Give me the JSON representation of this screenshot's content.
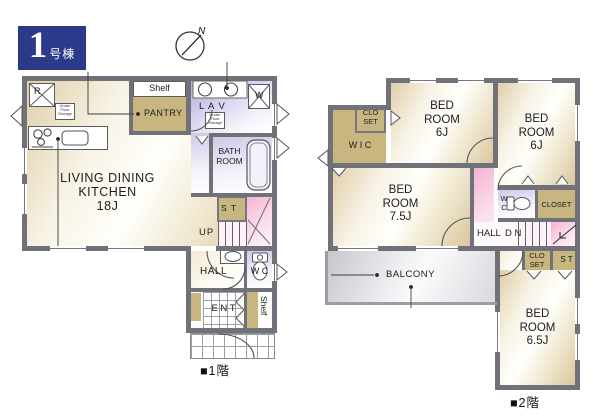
{
  "badge": {
    "number": "1",
    "suffix": "号棟"
  },
  "compass": {
    "north_label": "N"
  },
  "colors": {
    "badge_bg": "#2c3a8a",
    "wall": "#71717a",
    "closet_tan": "#c9b580",
    "stair_pink": "#f3b3d2",
    "wet_area_lavender": "#b3a7d8",
    "room_cream": "#dfcfa8",
    "balcony_gray": "#c6c6cc"
  },
  "floor1": {
    "caption": "■1階",
    "ldk": {
      "line1": "LIVING DINING",
      "line2": "KITCHEN",
      "line3": "18J"
    },
    "labels": {
      "shelf_top": "Shelf",
      "pantry": "PANTRY",
      "lav": "L A V",
      "bath_line1": "BATH",
      "bath_line2": "ROOM",
      "st": "S T",
      "up": "UP",
      "hall": "HALL",
      "wc": "W C",
      "ent": "E N T",
      "shelf_side": "Shelf",
      "fridge": "R",
      "washer": "W",
      "under_floor_storage": "Under Floor Storage"
    }
  },
  "floor2": {
    "caption": "■2階",
    "bedroom_nw": {
      "line1": "BED",
      "line2": "ROOM",
      "line3": "6J"
    },
    "bedroom_ne": {
      "line1": "BED",
      "line2": "ROOM",
      "line3": "6J"
    },
    "bedroom_w": {
      "line1": "BED",
      "line2": "ROOM",
      "line3": "7.5J"
    },
    "bedroom_se": {
      "line1": "BED",
      "line2": "ROOM",
      "line3": "6.5J"
    },
    "labels": {
      "wic": "W I C",
      "closet_nw_line1": "CLO",
      "closet_nw_line2": "SET",
      "wc_line1": "W",
      "wc_line2": "C",
      "closet_e": "CLOSET",
      "hall": "HALL",
      "dn": "D N",
      "closet_s_line1": "CLO",
      "closet_s_line2": "SET",
      "st": "S T",
      "balcony": "BALCONY"
    }
  }
}
